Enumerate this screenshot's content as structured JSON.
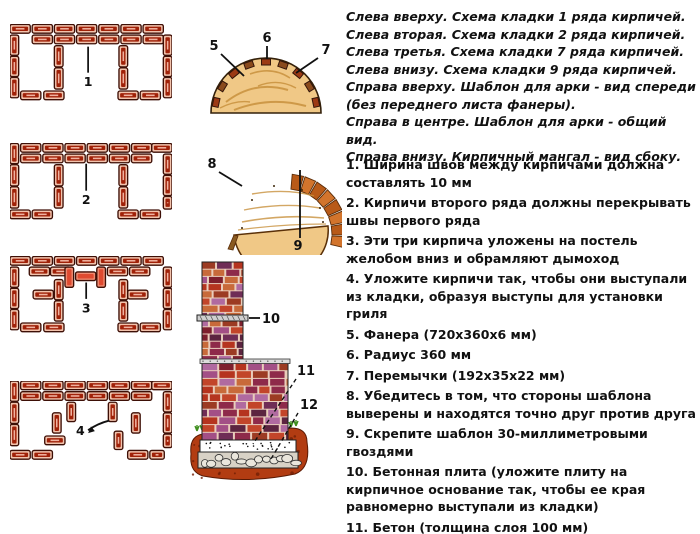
{
  "title": "Кирпичный мангал - схема кладки и шаблон для арки",
  "colors": {
    "background": "#ffffff",
    "text": "#111111",
    "brick_outline": "#3d0f06",
    "brick_face": "#f2c3ad",
    "brick_core": "#a02108",
    "brick_core_tick": "#f0b2a0",
    "brick_highlight_face": "#ef8a70",
    "brick_highlight_core": "#df4a30",
    "label_line": "#111111",
    "wood": "#f0c886",
    "wood_grain": "#c8913d",
    "wood_edge": "#5a3008",
    "block": "#8a4a1c",
    "block_alt": "#9c3a14",
    "slat_a": "#d2742c",
    "slat_b": "#b85a18",
    "masonry_palette": [
      "#b5341f",
      "#8e2a4a",
      "#a34f86",
      "#6f2d56",
      "#c2452a",
      "#7e1f2d",
      "#9c3b23",
      "#b06aa0",
      "#5c2440",
      "#c86a3a"
    ],
    "mortar": "#e9cdbb",
    "slab": "#cfcfcf",
    "concrete": "#ffffff",
    "rubble_bg": "#d8d2c6",
    "stone": "#eae6dc",
    "soil": "#b23c12",
    "soil_dark": "#701f06",
    "grass": "#3f8f1f"
  },
  "legend": {
    "lines": [
      "Слева вверху. Схема кладки 1 ряда кирпичей.",
      "Слева вторая. Схема кладки 2 ряда кирпичей.",
      "Слева третья. Схема кладки 7 ряда кирпичей.",
      "Слева внизу. Схема кладки 9 ряда кирпичей.",
      "Справа вверху. Шаблон для арки - вид спереди (без переднего листа фанеры).",
      "Справа в центре. Шаблон для арки - общий вид.",
      "Справа внизу. Кирпичный мангал - вид сбоку."
    ]
  },
  "instructions": {
    "items": [
      {
        "num": "1.",
        "text": "Ширина швов между кирпичами должна составлять 10 мм"
      },
      {
        "num": "2.",
        "text": "Кирпичи второго ряда должны перекрывать швы первого ряда"
      },
      {
        "num": "3.",
        "text": "Эти три кирпича уложены на постель желобом вниз и обрамляют дымоход"
      },
      {
        "num": "4.",
        "text": "Уложите кирпичи так, чтобы они выступали из кладки, образуя выступы для установки гриля"
      },
      {
        "num": "5.",
        "text": "Фанера (720x360x6 мм)"
      },
      {
        "num": "6.",
        "text": "Радиус 360 мм"
      },
      {
        "num": "7.",
        "text": "Перемычки (192x35x22 мм)"
      },
      {
        "num": "8.",
        "text": "Убедитесь в том, что стороны шаблона выверены и находятся точно друг против друга"
      },
      {
        "num": "9.",
        "text": "Скрепите шаблон 30-миллиметровыми гвоздями"
      },
      {
        "num": "10.",
        "text": "Бетонная плита (уложите плиту на кирпичное основание так, чтобы ее края равномерно выступали из кладки)"
      },
      {
        "num": "11.",
        "text": "Бетон (толщина слоя 100 мм)"
      },
      {
        "num": "12.",
        "text": "Щебень (толщина слоя 130 мм)"
      }
    ]
  },
  "diagrams": [
    {
      "id": "row1",
      "label": {
        "text": "1",
        "line": [
          81,
          23,
          81,
          50
        ],
        "pos": [
          81,
          64
        ]
      },
      "bricks": [
        [
          0,
          0,
          21,
          9
        ],
        [
          23,
          0,
          21,
          9
        ],
        [
          46,
          0,
          21,
          9
        ],
        [
          69,
          0,
          21,
          9
        ],
        [
          92,
          0,
          21,
          9
        ],
        [
          115,
          0,
          21,
          9
        ],
        [
          138,
          0,
          21,
          9
        ],
        [
          23,
          11,
          21,
          9
        ],
        [
          46,
          11,
          21,
          9
        ],
        [
          69,
          11,
          21,
          9
        ],
        [
          92,
          11,
          21,
          9
        ],
        [
          115,
          11,
          21,
          9
        ],
        [
          138,
          11,
          21,
          9
        ],
        [
          159,
          11,
          9,
          21
        ],
        [
          0,
          11,
          9,
          21
        ],
        [
          0,
          33,
          9,
          21
        ],
        [
          0,
          55,
          9,
          21
        ],
        [
          11,
          69,
          21,
          9
        ],
        [
          46,
          22,
          9,
          22
        ],
        [
          46,
          45,
          9,
          22
        ],
        [
          35,
          69,
          21,
          9
        ],
        [
          113,
          22,
          9,
          22
        ],
        [
          113,
          45,
          9,
          22
        ],
        [
          112,
          69,
          21,
          9
        ],
        [
          159,
          33,
          9,
          21
        ],
        [
          159,
          55,
          9,
          21
        ],
        [
          135,
          69,
          21,
          9
        ]
      ]
    },
    {
      "id": "row2",
      "label": {
        "text": "2",
        "line": [
          79,
          21,
          79,
          49
        ],
        "pos": [
          79,
          63
        ]
      },
      "bricks": [
        [
          0,
          0,
          9,
          21
        ],
        [
          11,
          0,
          21,
          9
        ],
        [
          34,
          0,
          21,
          9
        ],
        [
          57,
          0,
          21,
          9
        ],
        [
          80,
          0,
          21,
          9
        ],
        [
          103,
          0,
          21,
          9
        ],
        [
          126,
          0,
          21,
          9
        ],
        [
          147,
          0,
          21,
          9
        ],
        [
          11,
          11,
          21,
          9
        ],
        [
          34,
          11,
          21,
          9
        ],
        [
          57,
          11,
          21,
          9
        ],
        [
          80,
          11,
          21,
          9
        ],
        [
          103,
          11,
          21,
          9
        ],
        [
          126,
          11,
          21,
          9
        ],
        [
          159,
          11,
          9,
          21
        ],
        [
          0,
          22,
          9,
          22
        ],
        [
          0,
          45,
          9,
          22
        ],
        [
          0,
          69,
          21,
          9
        ],
        [
          23,
          69,
          21,
          9
        ],
        [
          46,
          22,
          9,
          22
        ],
        [
          46,
          45,
          9,
          22
        ],
        [
          113,
          22,
          9,
          22
        ],
        [
          113,
          45,
          9,
          22
        ],
        [
          159,
          33,
          9,
          21
        ],
        [
          159,
          55,
          9,
          13
        ],
        [
          112,
          69,
          21,
          9
        ],
        [
          135,
          69,
          21,
          9
        ]
      ]
    },
    {
      "id": "row7",
      "label": {
        "text": "3",
        "line": [
          79,
          27,
          79,
          44
        ],
        "pos": [
          79,
          58
        ]
      },
      "bricks": [
        [
          0,
          0,
          21,
          9
        ],
        [
          23,
          0,
          21,
          9
        ],
        [
          46,
          0,
          21,
          9
        ],
        [
          69,
          0,
          21,
          9
        ],
        [
          92,
          0,
          21,
          9
        ],
        [
          115,
          0,
          21,
          9
        ],
        [
          138,
          0,
          21,
          9
        ],
        [
          20,
          11,
          21,
          9
        ],
        [
          42,
          11,
          21,
          9
        ],
        [
          101,
          11,
          21,
          9
        ],
        [
          124,
          11,
          21,
          9
        ],
        [
          57,
          11,
          9,
          21,
          1
        ],
        [
          68,
          16,
          21,
          9,
          1
        ],
        [
          90,
          11,
          9,
          21,
          1
        ],
        [
          0,
          11,
          9,
          21
        ],
        [
          0,
          33,
          9,
          21
        ],
        [
          0,
          55,
          9,
          21
        ],
        [
          11,
          69,
          21,
          9
        ],
        [
          24,
          35,
          21,
          9
        ],
        [
          46,
          24,
          9,
          21
        ],
        [
          46,
          46,
          9,
          21
        ],
        [
          35,
          69,
          21,
          9
        ],
        [
          122,
          35,
          21,
          9
        ],
        [
          113,
          24,
          9,
          21
        ],
        [
          113,
          46,
          9,
          21
        ],
        [
          112,
          69,
          21,
          9
        ],
        [
          159,
          11,
          9,
          21
        ],
        [
          159,
          33,
          9,
          21
        ],
        [
          159,
          55,
          9,
          21
        ],
        [
          135,
          69,
          21,
          9
        ]
      ]
    },
    {
      "id": "row9",
      "label": {
        "text": "4",
        "pos": [
          73,
          56
        ],
        "arrow": "M 103,41 Q 91,44 81,51"
      },
      "bricks": [
        [
          0,
          0,
          9,
          21
        ],
        [
          11,
          0,
          21,
          9
        ],
        [
          34,
          0,
          21,
          9
        ],
        [
          57,
          0,
          21,
          9
        ],
        [
          80,
          0,
          21,
          9
        ],
        [
          103,
          0,
          21,
          9
        ],
        [
          126,
          0,
          21,
          9
        ],
        [
          147,
          0,
          21,
          9
        ],
        [
          11,
          11,
          21,
          9
        ],
        [
          34,
          11,
          21,
          9
        ],
        [
          57,
          11,
          21,
          9
        ],
        [
          80,
          11,
          21,
          9
        ],
        [
          103,
          11,
          21,
          9
        ],
        [
          126,
          11,
          21,
          9
        ],
        [
          159,
          11,
          9,
          21
        ],
        [
          0,
          22,
          9,
          22
        ],
        [
          0,
          45,
          9,
          22
        ],
        [
          0,
          72,
          21,
          9
        ],
        [
          23,
          72,
          21,
          9
        ],
        [
          59,
          22,
          9,
          20
        ],
        [
          44,
          33,
          9,
          21
        ],
        [
          36,
          57,
          21,
          9
        ],
        [
          102,
          22,
          9,
          20
        ],
        [
          126,
          33,
          9,
          21
        ],
        [
          108,
          52,
          9,
          19
        ],
        [
          122,
          72,
          21,
          9
        ],
        [
          145,
          72,
          15,
          9
        ],
        [
          159,
          33,
          9,
          21
        ],
        [
          159,
          55,
          9,
          14
        ]
      ]
    }
  ],
  "arch_front": {
    "labels": [
      {
        "text": "5",
        "pos": [
          22,
          22
        ],
        "line": [
          29,
          26,
          52,
          48
        ]
      },
      {
        "text": "6",
        "pos": [
          75,
          14
        ],
        "line": [
          75,
          18,
          75,
          31
        ]
      },
      {
        "text": "7",
        "pos": [
          134,
          26
        ],
        "line": [
          126,
          30,
          104,
          45
        ]
      }
    ],
    "block_count": 9
  },
  "arch_side": {
    "labels": [
      {
        "text": "8",
        "pos": [
          20,
          18
        ],
        "line": [
          27,
          22,
          50,
          36
        ]
      },
      {
        "text": "9",
        "pos": [
          106,
          100
        ],
        "line": [
          108,
          20,
          108,
          88
        ]
      }
    ]
  },
  "mangal": {
    "labels": [
      {
        "text": "10",
        "pos": [
          77,
          65
        ],
        "line": [
          64,
          60,
          75,
          60
        ]
      },
      {
        "text": "11",
        "pos": [
          112,
          117
        ],
        "dash": [
          111,
          121,
          68,
          186
        ]
      },
      {
        "text": "12",
        "pos": [
          115,
          151
        ],
        "dash": [
          113,
          155,
          86,
          201
        ]
      }
    ]
  }
}
